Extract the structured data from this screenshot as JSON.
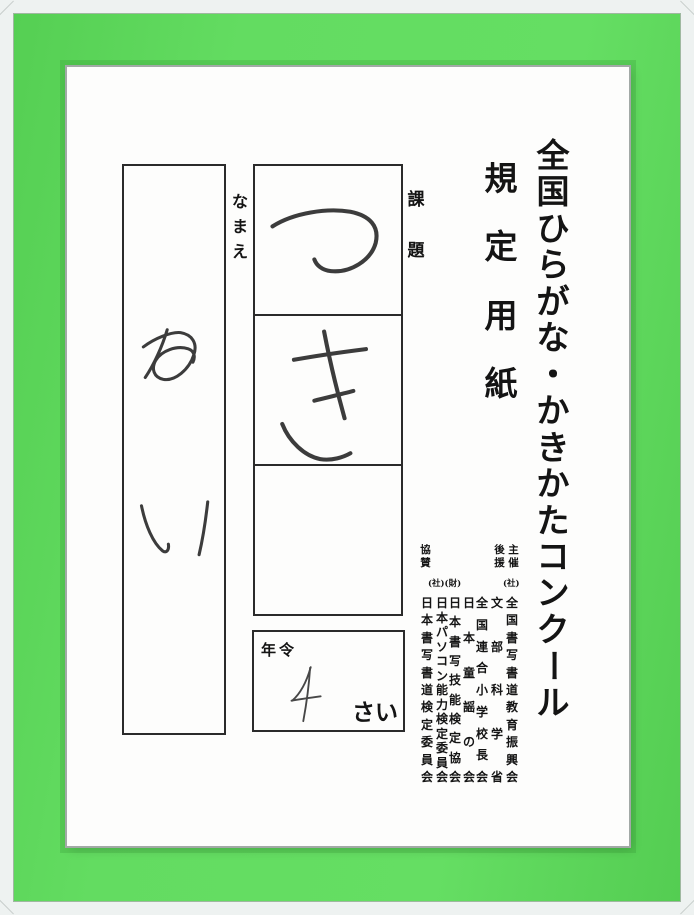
{
  "photo": {
    "frame_color": "#5fd75c",
    "frame_border_color": "#eef2f1",
    "paper_color": "#fdfdfc"
  },
  "paper": {
    "title": "全国ひらがな・かきかたコンクール",
    "subtitle": "規定用紙",
    "name_field": {
      "label": "なまえ",
      "value": "めい"
    },
    "task_field": {
      "label": "課題",
      "value": "つき",
      "boxes": [
        "つ",
        "き",
        ""
      ]
    },
    "age_field": {
      "label": "年令",
      "value": "4",
      "unit": "さい"
    },
    "organizers": {
      "host_label": "主催",
      "host_prefix": "(社)",
      "support_label": "後援",
      "cooperation_label": "協賛",
      "cooperation_prefix": "(社)(財)",
      "columns": [
        "全国書写書道教育振興会",
        "文部科学省",
        "全国連合小学校長会",
        "日本童謡の会",
        "日本書写技能検定協会",
        "日本パソコン能力検定委員会",
        "日本書写書道検定委員会"
      ]
    }
  }
}
